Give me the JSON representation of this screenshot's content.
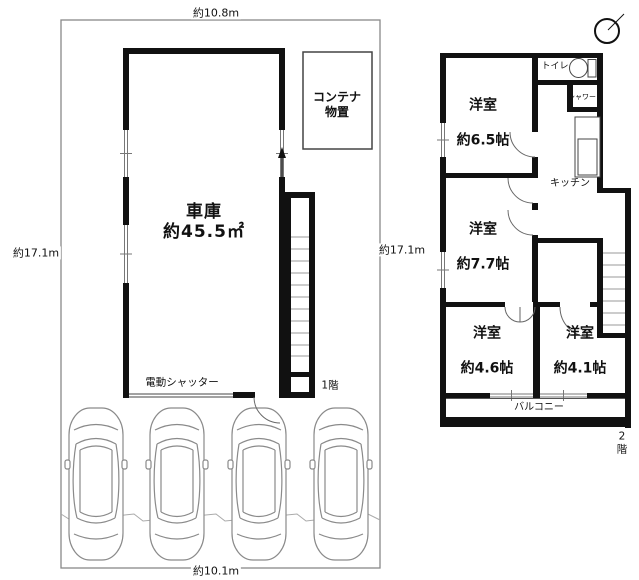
{
  "site": {
    "dim_top": "約10.8m",
    "dim_left": "約17.1m",
    "dim_right": "約17.1m",
    "dim_bottom": "約10.1m"
  },
  "floor1": {
    "label": "1階",
    "garage": {
      "name": "車庫",
      "area": "約45.5㎡"
    },
    "container": "コンテナ\n物置",
    "shutter": "電動シャッター",
    "car_count": 4
  },
  "floor2": {
    "label": "2階",
    "rooms": [
      {
        "name": "洋室",
        "size": "約6.5帖"
      },
      {
        "name": "洋室",
        "size": "約7.7帖"
      },
      {
        "name": "洋室",
        "size": "約4.6帖"
      },
      {
        "name": "洋室",
        "size": "約4.1帖"
      }
    ],
    "toilet": "トイレ",
    "shower": "シャワー",
    "kitchen": "キッチン",
    "balcony": "バルコニー"
  },
  "icons": {
    "compass": "north-compass-icon",
    "toilet": "toilet-bowl-icon",
    "car": "car-top-view-icon"
  },
  "colors": {
    "wall": "#111111",
    "thin_line": "#555555",
    "boundary": "#888888",
    "car_line": "#8a8a8a",
    "background": "#ffffff"
  }
}
